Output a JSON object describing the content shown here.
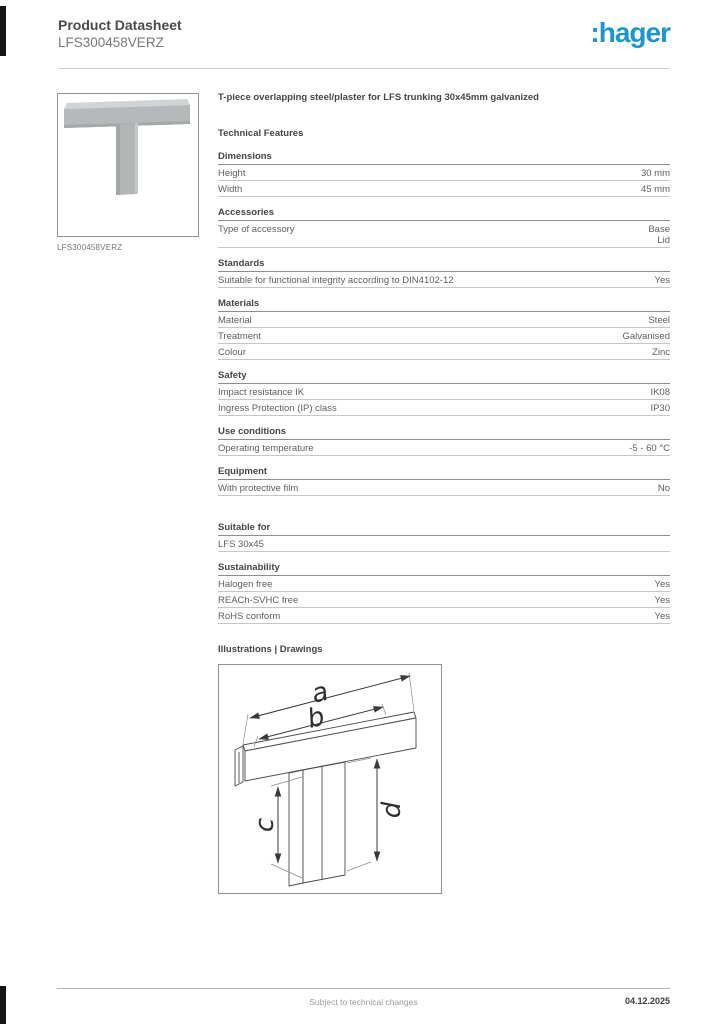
{
  "header": {
    "title": "Product Datasheet",
    "product_code": "LFS300458VERZ",
    "logo_text": ":hager",
    "logo_color": "#1a96d4"
  },
  "product_image": {
    "caption": "LFS300458VERZ"
  },
  "main": {
    "product_title": "T-piece overlapping steel/plaster for LFS trunking 30x45mm galvanized",
    "technical_features_heading": "Technical Features",
    "sections": [
      {
        "heading": "Dimensions",
        "rows": [
          {
            "label": "Height",
            "value": "30 mm"
          },
          {
            "label": "Width",
            "value": "45 mm"
          }
        ]
      },
      {
        "heading": "Accessories",
        "rows": [
          {
            "label": "Type of accessory",
            "value": "Base\nLid"
          }
        ]
      },
      {
        "heading": "Standards",
        "rows": [
          {
            "label": "Suitable for functional integrity according to DIN4102-12",
            "value": "Yes"
          }
        ]
      },
      {
        "heading": "Materials",
        "rows": [
          {
            "label": "Material",
            "value": "Steel"
          },
          {
            "label": "Treatment",
            "value": "Galvanised"
          },
          {
            "label": "Colour",
            "value": "Zinc"
          }
        ]
      },
      {
        "heading": "Safety",
        "rows": [
          {
            "label": "Impact resistance IK",
            "value": "IK08"
          },
          {
            "label": "Ingress Protection (IP) class",
            "value": "IP30"
          }
        ]
      },
      {
        "heading": "Use conditions",
        "rows": [
          {
            "label": "Operating temperature",
            "value": "-5 - 60 °C"
          }
        ]
      },
      {
        "heading": "Equipment",
        "rows": [
          {
            "label": "With protective film",
            "value": "No"
          }
        ]
      },
      {
        "heading": "Suitable for",
        "extra_gap": true,
        "rows": [
          {
            "label": "LFS 30x45",
            "value": ""
          }
        ]
      },
      {
        "heading": "Sustainability",
        "rows": [
          {
            "label": "Halogen free",
            "value": "Yes"
          },
          {
            "label": "REACh-SVHC free",
            "value": "Yes"
          },
          {
            "label": "RoHS conform",
            "value": "Yes"
          }
        ]
      }
    ],
    "illustrations_heading": "Illustrations | Drawings",
    "drawing": {
      "labels": {
        "a": "a",
        "b": "b",
        "c": "c",
        "d": "d"
      }
    }
  },
  "footer": {
    "note": "Subject to technical changes",
    "date": "04.12.2025"
  }
}
